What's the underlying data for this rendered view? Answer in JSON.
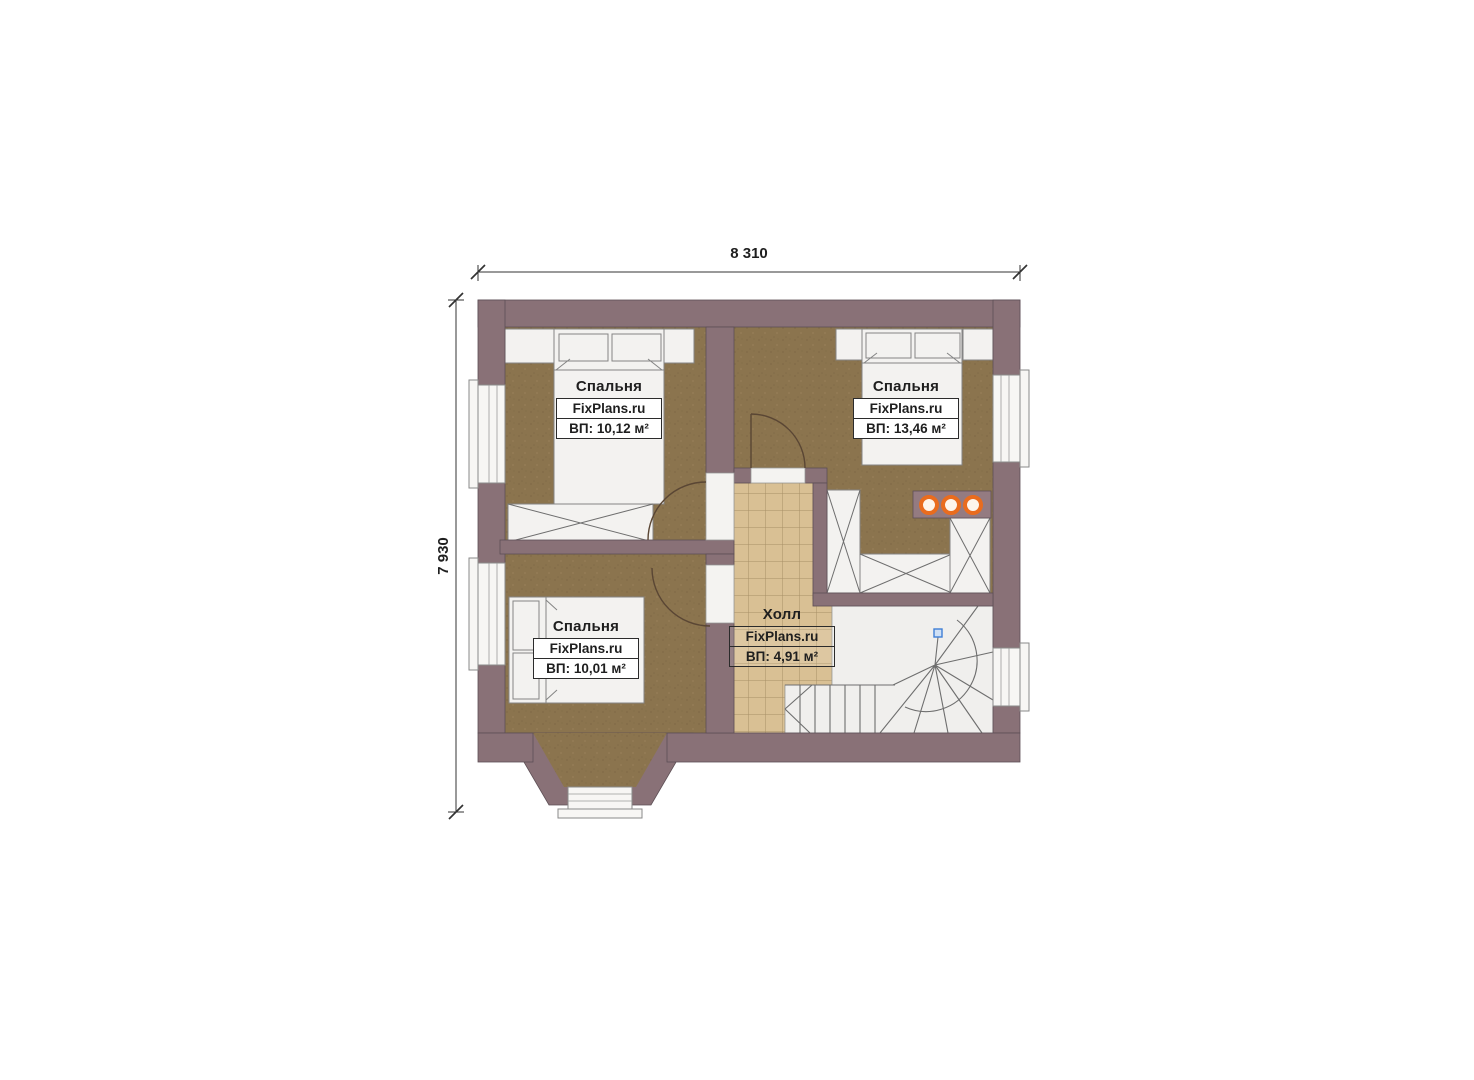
{
  "page": {
    "background": "#ffffff"
  },
  "dimensions": {
    "width_label": "8 310",
    "height_label": "7 930"
  },
  "rooms": [
    {
      "name": "Спальня",
      "brand": "FixPlans.ru",
      "area": "ВП: 10,12 м²"
    },
    {
      "name": "Спальня",
      "brand": "FixPlans.ru",
      "area": "ВП: 13,46 м²"
    },
    {
      "name": "Спальня",
      "brand": "FixPlans.ru",
      "area": "ВП: 10,01 м²"
    },
    {
      "name": "Холл",
      "brand": "FixPlans.ru",
      "area": "ВП: 4,91 м²"
    }
  ],
  "colors": {
    "wall": "#897177",
    "wall-line": "#5d4f55",
    "floor": "#8b744e",
    "tile": "#d9c094",
    "tile-line": "#a78f66",
    "white-floor": "#f0efed",
    "accent-orange": "#e96c1e",
    "marker-blue": "#3f7fd6",
    "door-line": "#5a4634",
    "dim-line": "#333333",
    "text": "#1f1f1f"
  }
}
